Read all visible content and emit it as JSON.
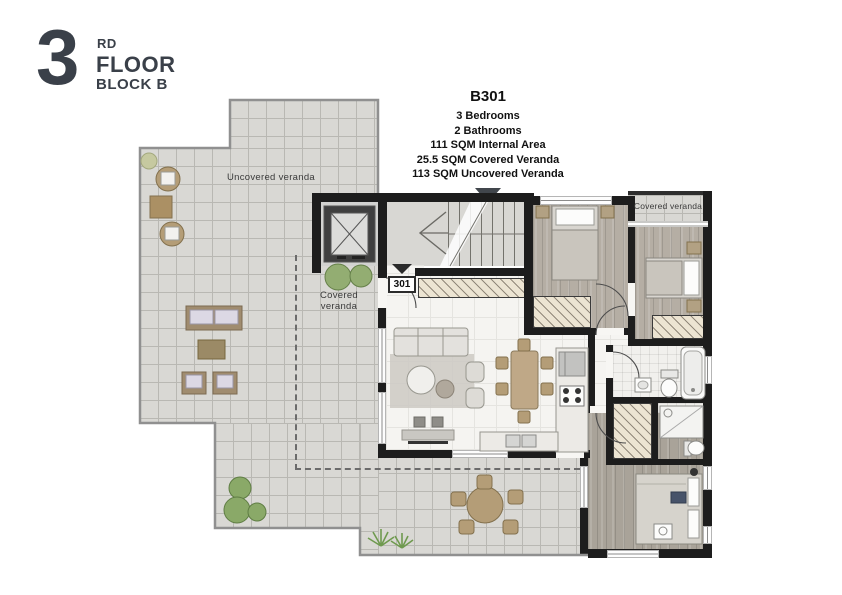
{
  "header": {
    "floor_number": "3",
    "floor_ordinal": "RD",
    "floor_label": "FLOOR",
    "block_label": "BLOCK B",
    "text_color": "#3a4049"
  },
  "unit": {
    "code": "B301",
    "specs": [
      "3 Bedrooms",
      "2 Bathrooms",
      "111 SQM Internal Area",
      "25.5 SQM Covered Veranda",
      "113 SQM Uncovered Veranda"
    ]
  },
  "plan": {
    "labels": {
      "uncovered_veranda": "Uncovered veranda",
      "covered_veranda": "Covered veranda",
      "covered_veranda_top": "Covered veranda",
      "door_number": "301"
    },
    "colors": {
      "wall": "#1d1d1d",
      "tile": "#d9d8d4",
      "interior_floor": "#f5f4f1",
      "wood": "#b5aea4",
      "wardrobe_hatch": "#ece4d2",
      "plant_green": "#7fa35c",
      "outline_gray": "#909090",
      "furniture_tan": "#b49d77",
      "accent_text": "#3a4049"
    }
  }
}
